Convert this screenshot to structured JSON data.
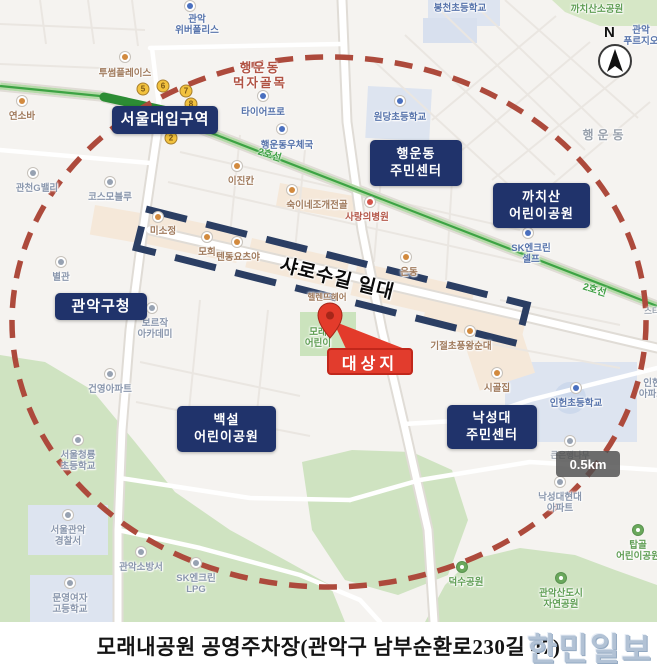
{
  "caption": {
    "text": "모래내공원 공영주차장(관악구 남부순환로230길 47)",
    "watermark": "한민일보"
  },
  "compass": {
    "label": "N"
  },
  "scale": {
    "label": "0.5km"
  },
  "overlay": {
    "rect_label": "샤로수길 일대",
    "target_label": "대상지"
  },
  "colors": {
    "circle_dash": "#ad4a3c",
    "rect_dash": "#2b3e63",
    "target_red": "#e23c2d",
    "marker_navy": "#20336b",
    "subway_green": "#3da344"
  },
  "navy": {
    "snu_station": {
      "line1": "서울대입구역"
    },
    "haengun_center": {
      "line1": "행운동",
      "line2": "주민센터"
    },
    "kkachisan_park": {
      "line1": "까치산",
      "line2": "어린이공원"
    },
    "gu_office": {
      "line1": "관악구청"
    },
    "baekseol_park": {
      "line1": "백설",
      "line2": "어린이공원"
    },
    "nakseongdae_center": {
      "line1": "낙성대",
      "line2": "주민센터"
    }
  },
  "subway": {
    "name_a": "2호선",
    "name_b": "2호선",
    "exits": [
      "5",
      "6",
      "7",
      "8",
      "2"
    ]
  },
  "pois": {
    "twosome": "투썸플레이스",
    "yeonsoba": "연소바",
    "tirepro": "타이어프로",
    "postoffice": "행운동우체국",
    "ijinkan": "이진칸",
    "wondang": "원당초등학교",
    "bongcheon": "봉천초등학교",
    "kkachisan_small": "까치산소공원",
    "haengun_dong": "행운동",
    "sarang": "사랑의병원",
    "sugine": "숙이네조개전골",
    "misojeong": "미소정",
    "mohee": "모희",
    "tendon": "텐동요츠야",
    "helen": "헬렌뜨헤어",
    "eundong": "은동",
    "gijeol": "기절초풍왕순대",
    "cosmoblue": "코스모블루",
    "gwancheon": "관천G밸리",
    "byeolgwan": "별관",
    "gunyoung": "건영아파트",
    "fire": "관악소방서",
    "sigoljip": "시골집",
    "inheon_elem": "인헌초등학교",
    "keuneun": "큰은행나무",
    "deoksu": "덕수공원",
    "sta": "스타"
  },
  "pois2": {
    "weber": {
      "l1": "관악",
      "l2": "위버폴리스"
    },
    "meokja": {
      "l1": "행운동",
      "l2": "먹자골목"
    },
    "purgio": {
      "l1": "관악",
      "l2": "푸르지오"
    },
    "sk_self": {
      "l1": "SK엔크린",
      "l2": "셀프"
    },
    "boreujak": {
      "l1": "보르작",
      "l2": "아카데미"
    },
    "cheongryong": {
      "l1": "서울청룡",
      "l2": "초등학교"
    },
    "police": {
      "l1": "서울관악",
      "l2": "경찰서"
    },
    "sk_lpg": {
      "l1": "SK엔크린",
      "l2": "LPG"
    },
    "munyoung": {
      "l1": "문영여자",
      "l2": "고등학교"
    },
    "nak_apt": {
      "l1": "낙성대현대",
      "l2": "아파트"
    },
    "inheon_apt": {
      "l1": "인헌",
      "l2": "아파트"
    },
    "mole_park": {
      "l1": "모래",
      "l2": "어린이"
    },
    "topgol": {
      "l1": "탑골",
      "l2": "어린이공원"
    },
    "gwanaksan": {
      "l1": "관악산도시",
      "l2": "자연공원"
    }
  }
}
